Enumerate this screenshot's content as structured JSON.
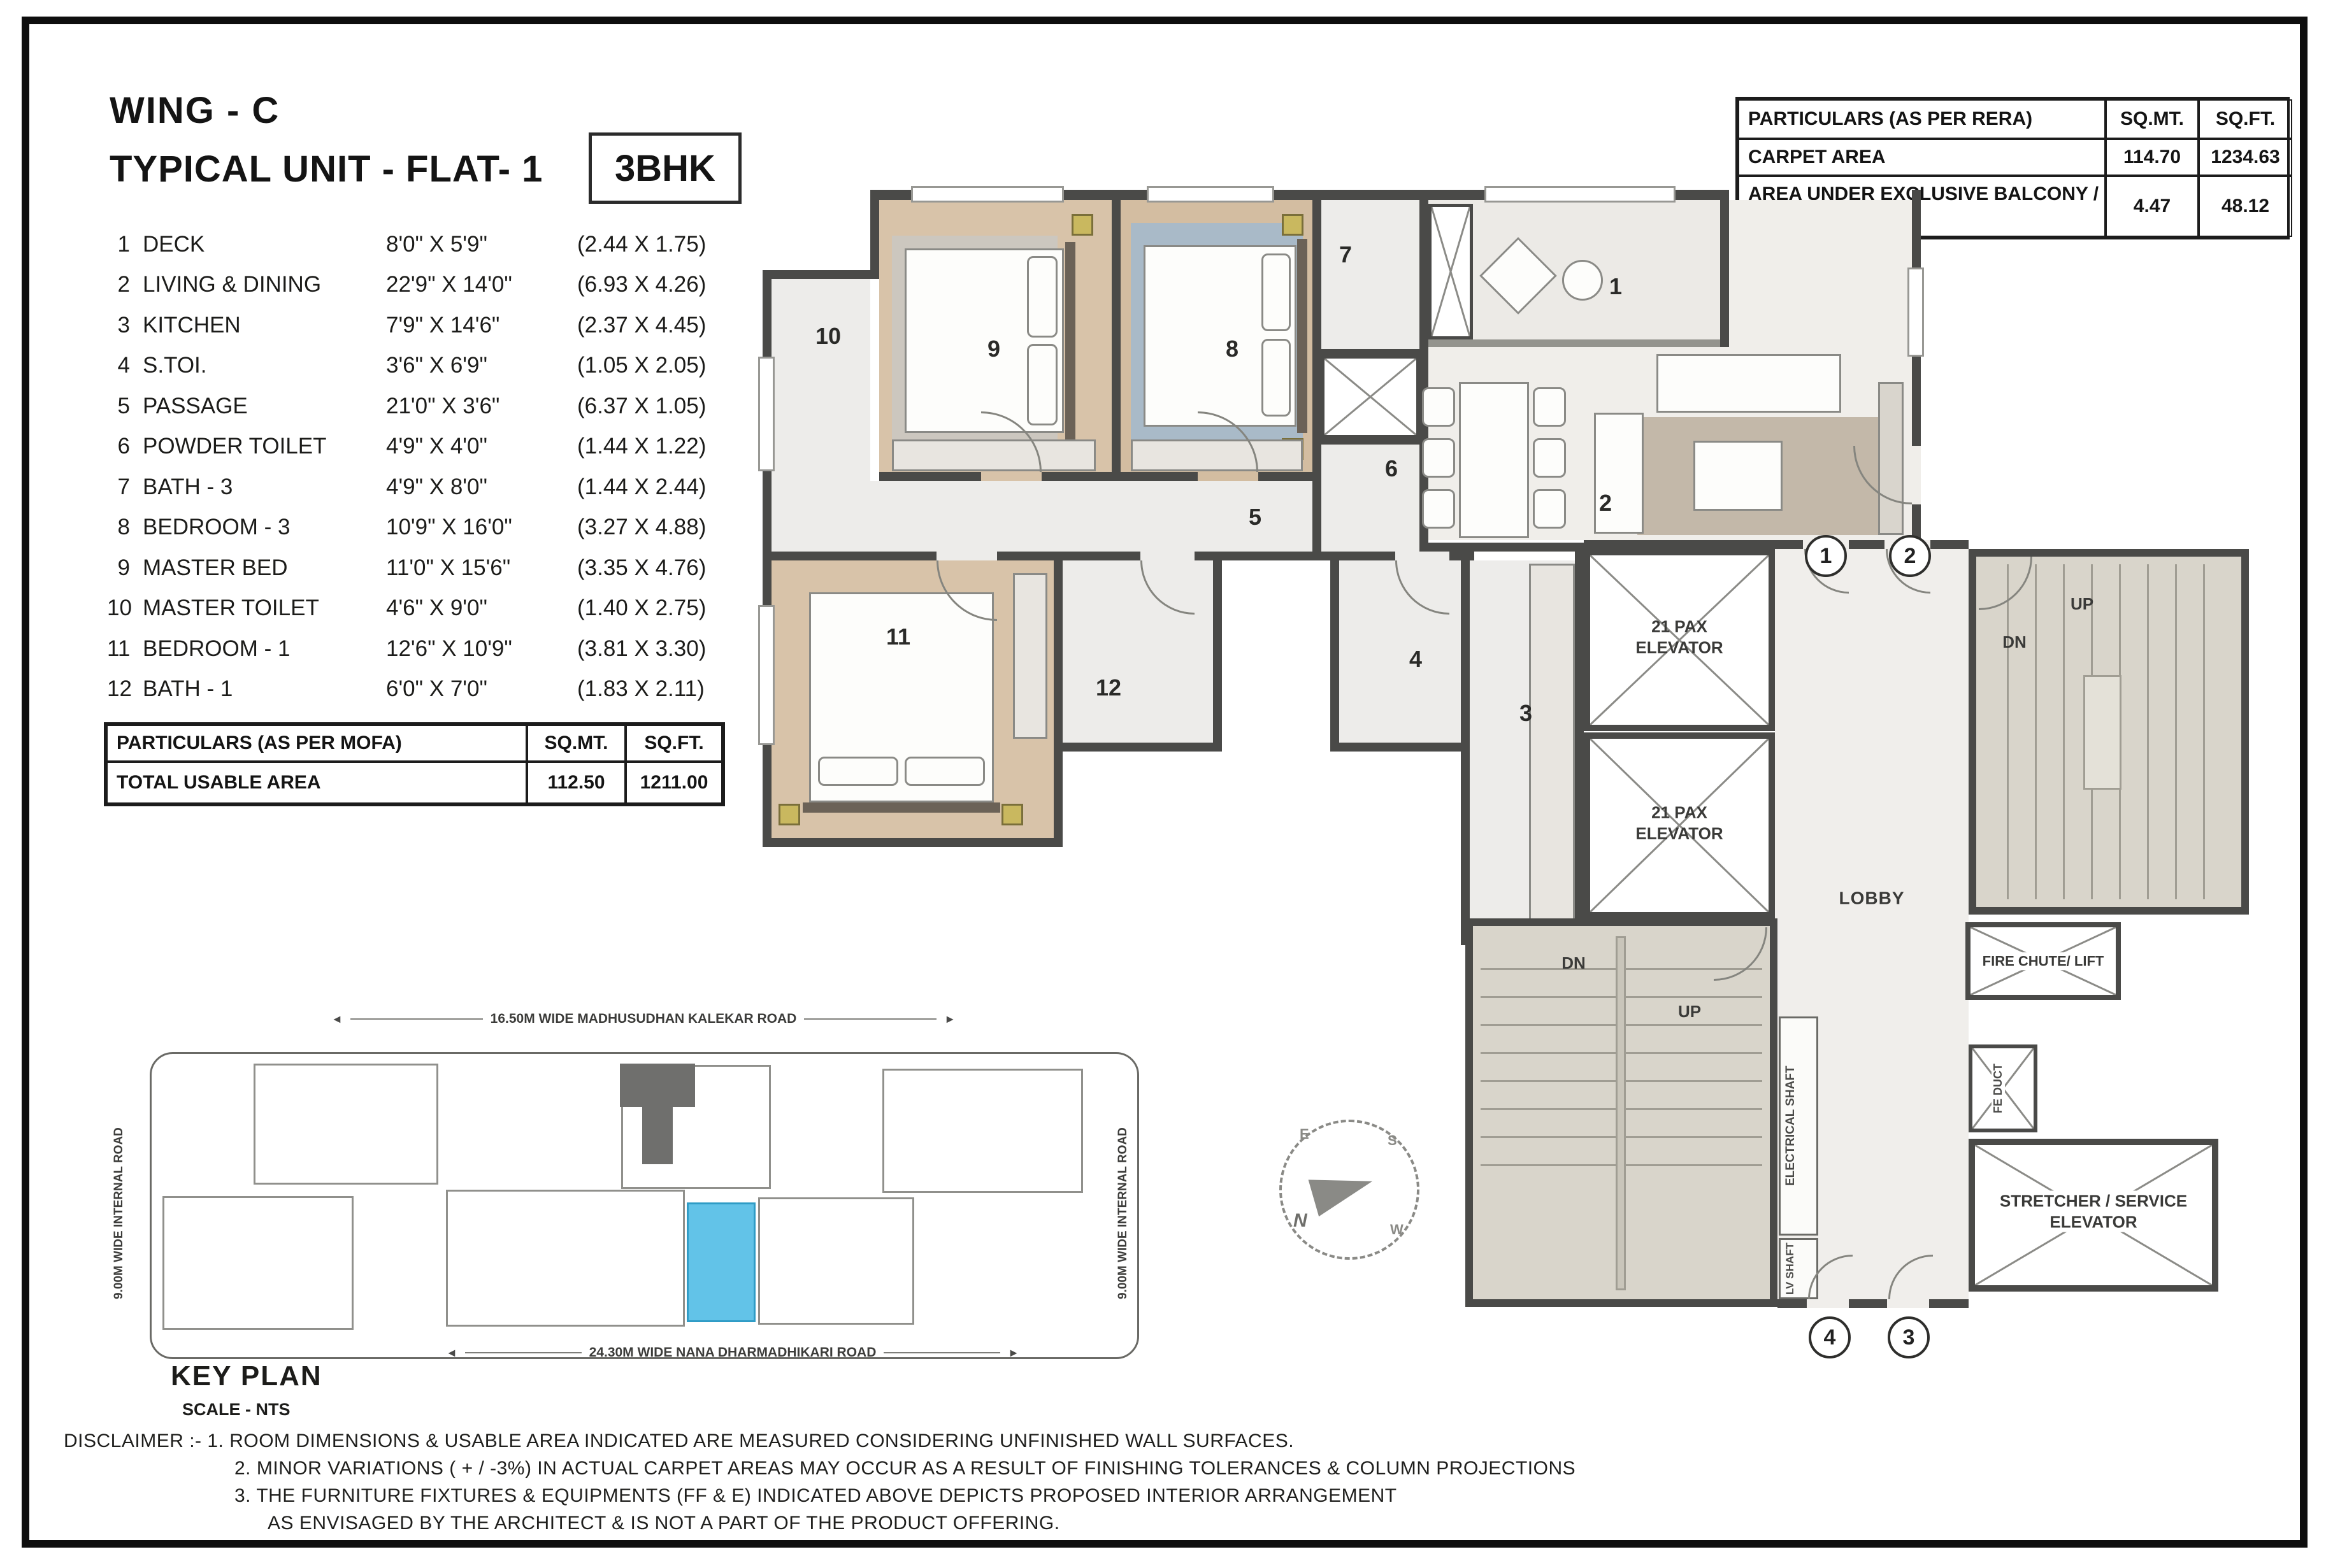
{
  "header": {
    "wing": "WING - C",
    "unit": "TYPICAL UNIT - FLAT- 1",
    "bhk": "3BHK"
  },
  "room_list": [
    {
      "no": "1",
      "name": "DECK",
      "ft": "8'0\" X 5'9\"",
      "m": "(2.44 X 1.75)"
    },
    {
      "no": "2",
      "name": "LIVING & DINING",
      "ft": "22'9\" X 14'0\"",
      "m": "(6.93 X 4.26)"
    },
    {
      "no": "3",
      "name": "KITCHEN",
      "ft": "7'9\" X 14'6\"",
      "m": "(2.37 X 4.45)"
    },
    {
      "no": "4",
      "name": "S.TOI.",
      "ft": "3'6\" X 6'9\"",
      "m": "(1.05 X 2.05)"
    },
    {
      "no": "5",
      "name": "PASSAGE",
      "ft": "21'0\" X 3'6\"",
      "m": "(6.37 X 1.05)"
    },
    {
      "no": "6",
      "name": "POWDER TOILET",
      "ft": "4'9\" X 4'0\"",
      "m": "(1.44 X 1.22)"
    },
    {
      "no": "7",
      "name": "BATH - 3",
      "ft": "4'9\" X 8'0\"",
      "m": "(1.44 X 2.44)"
    },
    {
      "no": "8",
      "name": "BEDROOM - 3",
      "ft": "10'9\" X 16'0\"",
      "m": "(3.27 X 4.88)"
    },
    {
      "no": "9",
      "name": "MASTER BED",
      "ft": "11'0\" X 15'6\"",
      "m": "(3.35 X 4.76)"
    },
    {
      "no": "10",
      "name": "MASTER TOILET",
      "ft": "4'6\" X 9'0\"",
      "m": "(1.40 X 2.75)"
    },
    {
      "no": "11",
      "name": "BEDROOM - 1",
      "ft": "12'6\" X 10'9\"",
      "m": "(3.81 X 3.30)"
    },
    {
      "no": "12",
      "name": "BATH - 1",
      "ft": "6'0\" X 7'0\"",
      "m": "(1.83 X 2.11)"
    }
  ],
  "rera": {
    "title": "PARTICULARS (AS PER RERA)",
    "col1": "SQ.MT.",
    "col2": "SQ.FT.",
    "rows": [
      {
        "label": "CARPET AREA",
        "sqmt": "114.70",
        "sqft": "1234.63"
      },
      {
        "label": "AREA UNDER EXCLUSIVE BALCONY / DECK",
        "sqmt": "4.47",
        "sqft": "48.12"
      }
    ]
  },
  "mofa": {
    "title": "PARTICULARS (AS PER MOFA)",
    "col1": "SQ.MT.",
    "col2": "SQ.FT.",
    "rows": [
      {
        "label": "TOTAL USABLE AREA",
        "sqmt": "112.50",
        "sqft": "1211.00"
      }
    ]
  },
  "plan": {
    "elevator": "21 PAX ELEVATOR",
    "lobby": "LOBBY",
    "up": "UP",
    "dn": "DN",
    "fire_chute": "FIRE CHUTE/ LIFT",
    "stretcher": "STRETCHER / SERVICE ELEVATOR",
    "electrical_shaft": "ELECTRICAL SHAFT",
    "lv_shaft": "LV SHAFT",
    "fe_duct": "FE DUCT",
    "markers": {
      "m1": "1",
      "m2": "2",
      "m3": "3",
      "m4": "4"
    }
  },
  "key_plan": {
    "title": "KEY PLAN",
    "scale": "SCALE - NTS",
    "road_top": "16.50M WIDE MADHUSUDHAN KALEKAR ROAD",
    "road_bottom": "24.30M WIDE NANA DHARMADHIKARI ROAD",
    "road_left": "9.00M WIDE INTERNAL ROAD",
    "road_right": "9.00M WIDE INTERNAL ROAD"
  },
  "compass": {
    "n": "N",
    "e": "E",
    "s": "S",
    "w": "W"
  },
  "icons": {
    "arrow_left": "◄",
    "arrow_right": "►"
  },
  "disclaimer": {
    "line1": "DISCLAIMER :- 1. ROOM DIMENSIONS & USABLE  AREA INDICATED  ARE MEASURED CONSIDERING UNFINISHED WALL SURFACES.",
    "line2": "2. MINOR VARIATIONS ( + / -3%) IN ACTUAL CARPET AREAS MAY OCCUR AS A RESULT OF  FINISHING TOLERANCES & COLUMN PROJECTIONS",
    "line3": "3. THE FURNITURE FIXTURES & EQUIPMENTS (FF & E)  INDICATED ABOVE  DEPICTS PROPOSED INTERIOR ARRANGEMENT",
    "line4": "AS ENVISAGED BY  THE ARCHITECT & IS NOT A PART OF THE PRODUCT OFFERING."
  },
  "colors": {
    "wall": "#4a4a48",
    "wood": "#d8c3a9",
    "tile": "#edecea",
    "lobby": "#f0eeeb",
    "core": "#d9d5cb",
    "rug_blue": "#a9bac8",
    "rug_tan": "#c3b8a9",
    "accent_blue": "#62c3e8",
    "lamp": "#c9b85f"
  }
}
